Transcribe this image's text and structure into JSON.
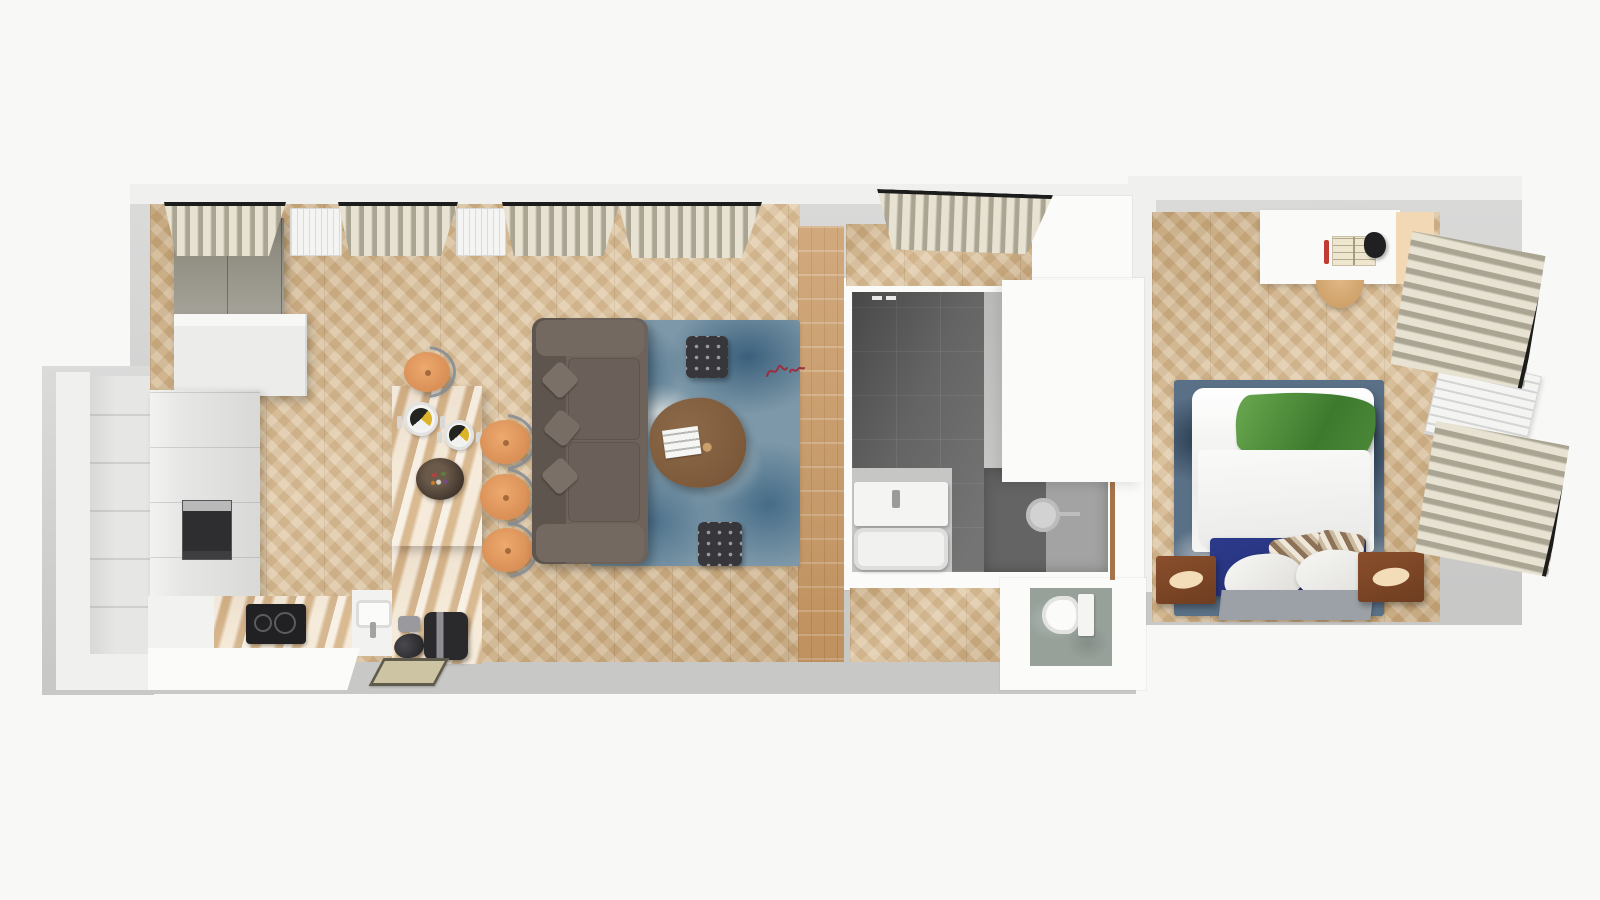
{
  "image": {
    "kind": "3d-floor-plan-top-down-render",
    "width_px": 1600,
    "height_px": 900,
    "visible_text": "none (only an illegible small red hand-drawn marking on the floor near the hallway)"
  },
  "palette": {
    "page_bg": "#f8f8f6",
    "slab": "#dbdbda",
    "slab_dark": "#c8c8c7",
    "wall": "#f0f0ee",
    "wall_bright": "#fbfbfa",
    "wood": "#d9bb8e",
    "plank": "#c99a66",
    "marble": "#ecd6b4",
    "cabinet": "#e6e6e5",
    "wardrobe": "#8f8c80",
    "sofa": "#6e635b",
    "sofa_dark": "#5e554e",
    "rug_blue": "#7d98a8",
    "coffee_table": "#7d5a3b",
    "ottoman": "#37373b",
    "stool": "#d98f55",
    "tile": "#646464",
    "tile_light": "#a3a3a3",
    "vanity_zone": "#c6c6c5",
    "concrete": "#97a19a",
    "navy": "#222d6e",
    "throw_green": "#4c8a39",
    "mat": "#9ba1a6",
    "nightstand": "#6e3d20",
    "handle_cream": "#f3dcb8",
    "curtain_light": "#e7e2d1",
    "curtain_dark": "#aaa593",
    "radiator": "#f4f4f3",
    "rod": "#1c1c1c",
    "doormat": "#ccc4a2",
    "red_mark": "#9c2f3c",
    "desk_panel": "#f3d8b5",
    "appliance": "#2b2b2e",
    "bath_door_wood": "#a5754a",
    "duvet": "#f5f5f3",
    "bed_rug": "#5a7086"
  },
  "rooms": [
    {
      "id": "entry",
      "label": "entry hall with white closets"
    },
    {
      "id": "kitchen",
      "label": "kitchen with L-shaped counter"
    },
    {
      "id": "dining-area",
      "label": "dining area with marble table"
    },
    {
      "id": "living-room",
      "label": "living room"
    },
    {
      "id": "hallway",
      "label": "hallway with plank floor"
    },
    {
      "id": "bathroom",
      "label": "bathroom with dark tiles"
    },
    {
      "id": "toilet-room",
      "label": "separate WC"
    },
    {
      "id": "bedroom",
      "label": "bedroom"
    }
  ],
  "objects": {
    "kitchen": [
      "gray-wardrobe",
      "white-wall-cabinet",
      "tall-cabinet-column",
      "built-in-oven",
      "marble-counter",
      "induction-hob",
      "sink-with-faucet",
      "kettle",
      "coffee-machine",
      "storage-jar",
      "doormat"
    ],
    "dining_area": [
      "marble-dining-table",
      "round-stool x4",
      "place-setting-plate x2",
      "fruit-bowl"
    ],
    "living_room": [
      "gray-sofa",
      "blue-distressed-rug",
      "walnut-coffee-table",
      "magazine",
      "tufted-ottoman x2",
      "window-curtain x5",
      "wall-radiator x2",
      "red-scribble-marking"
    ],
    "bathroom": [
      "vanity-counter-with-sink",
      "bathtub",
      "walk-in-shower",
      "rain-shower-head",
      "wooden-door",
      "towel-hooks",
      "white-closet-block"
    ],
    "toilet_room": [
      "wall-hung-toilet",
      "concrete-floor"
    ],
    "bedroom": [
      "double-bed-white-duvet",
      "green-throw-blanket",
      "navy-bed-base",
      "striped-pillow x2",
      "white-pillow x2",
      "bedside-mat",
      "wood-nightstand x2",
      "blue-mottled-rug",
      "white-desk",
      "open-book",
      "red-pen",
      "desk-lamp",
      "beige-side-panel",
      "desk-stool",
      "wall-radiator",
      "window-curtain x2"
    ]
  }
}
